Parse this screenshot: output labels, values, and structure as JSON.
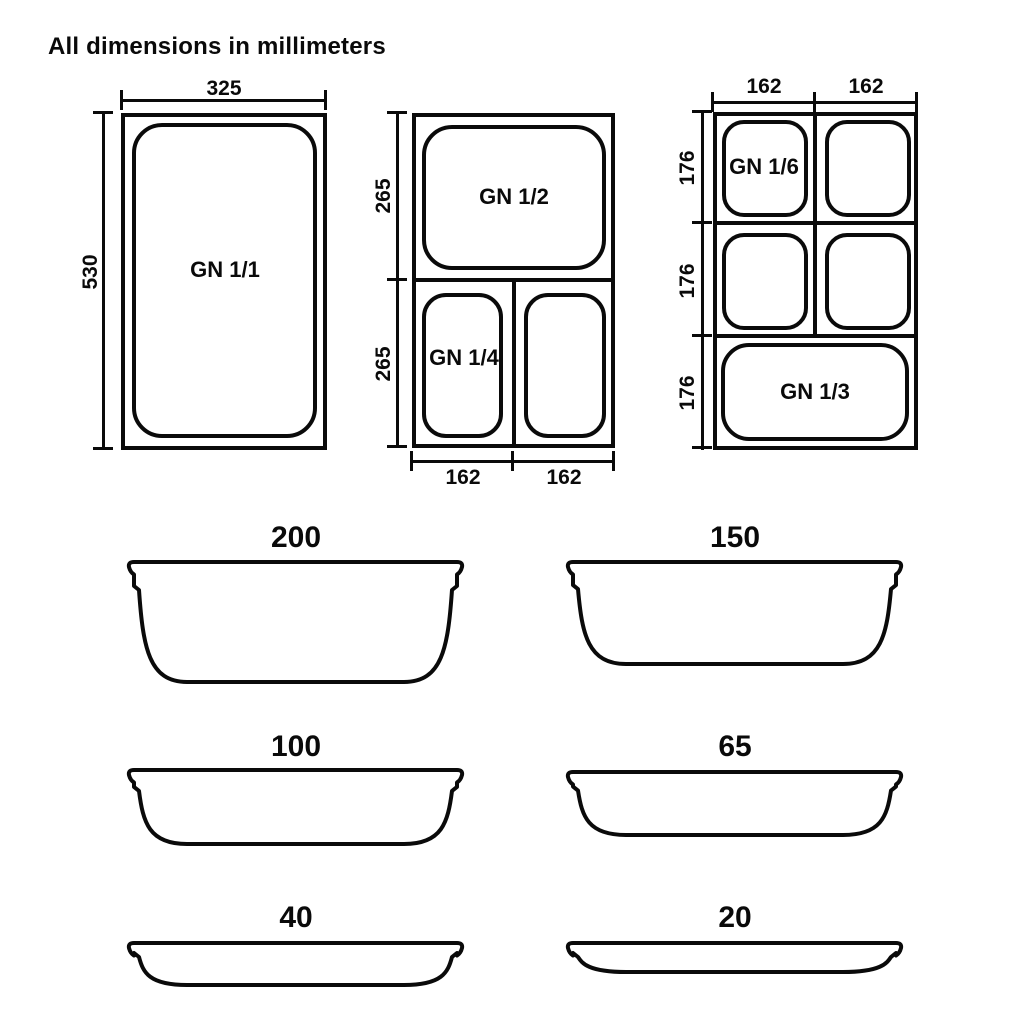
{
  "title": "All dimensions in millimeters",
  "colors": {
    "line": "#0a0a0a",
    "background": "#ffffff"
  },
  "plan_views": {
    "gn11": {
      "label": "GN 1/1",
      "width_mm": "325",
      "height_mm": "530"
    },
    "gn_half_quarter": {
      "label_top": "GN 1/2",
      "label_bottom_left": "GN 1/4",
      "dim_top_height": "265",
      "dim_bottom_height": "265",
      "dim_bottom_left_width": "162",
      "dim_bottom_right_width": "162"
    },
    "gn_sixth_third": {
      "label_sixth": "GN 1/6",
      "label_third": "GN 1/3",
      "dim_col1_width": "162",
      "dim_col2_width": "162",
      "dim_row1_height": "176",
      "dim_row2_height": "176",
      "dim_row3_height": "176"
    }
  },
  "profiles": {
    "depths": [
      "200",
      "150",
      "100",
      "65",
      "40",
      "20"
    ]
  }
}
